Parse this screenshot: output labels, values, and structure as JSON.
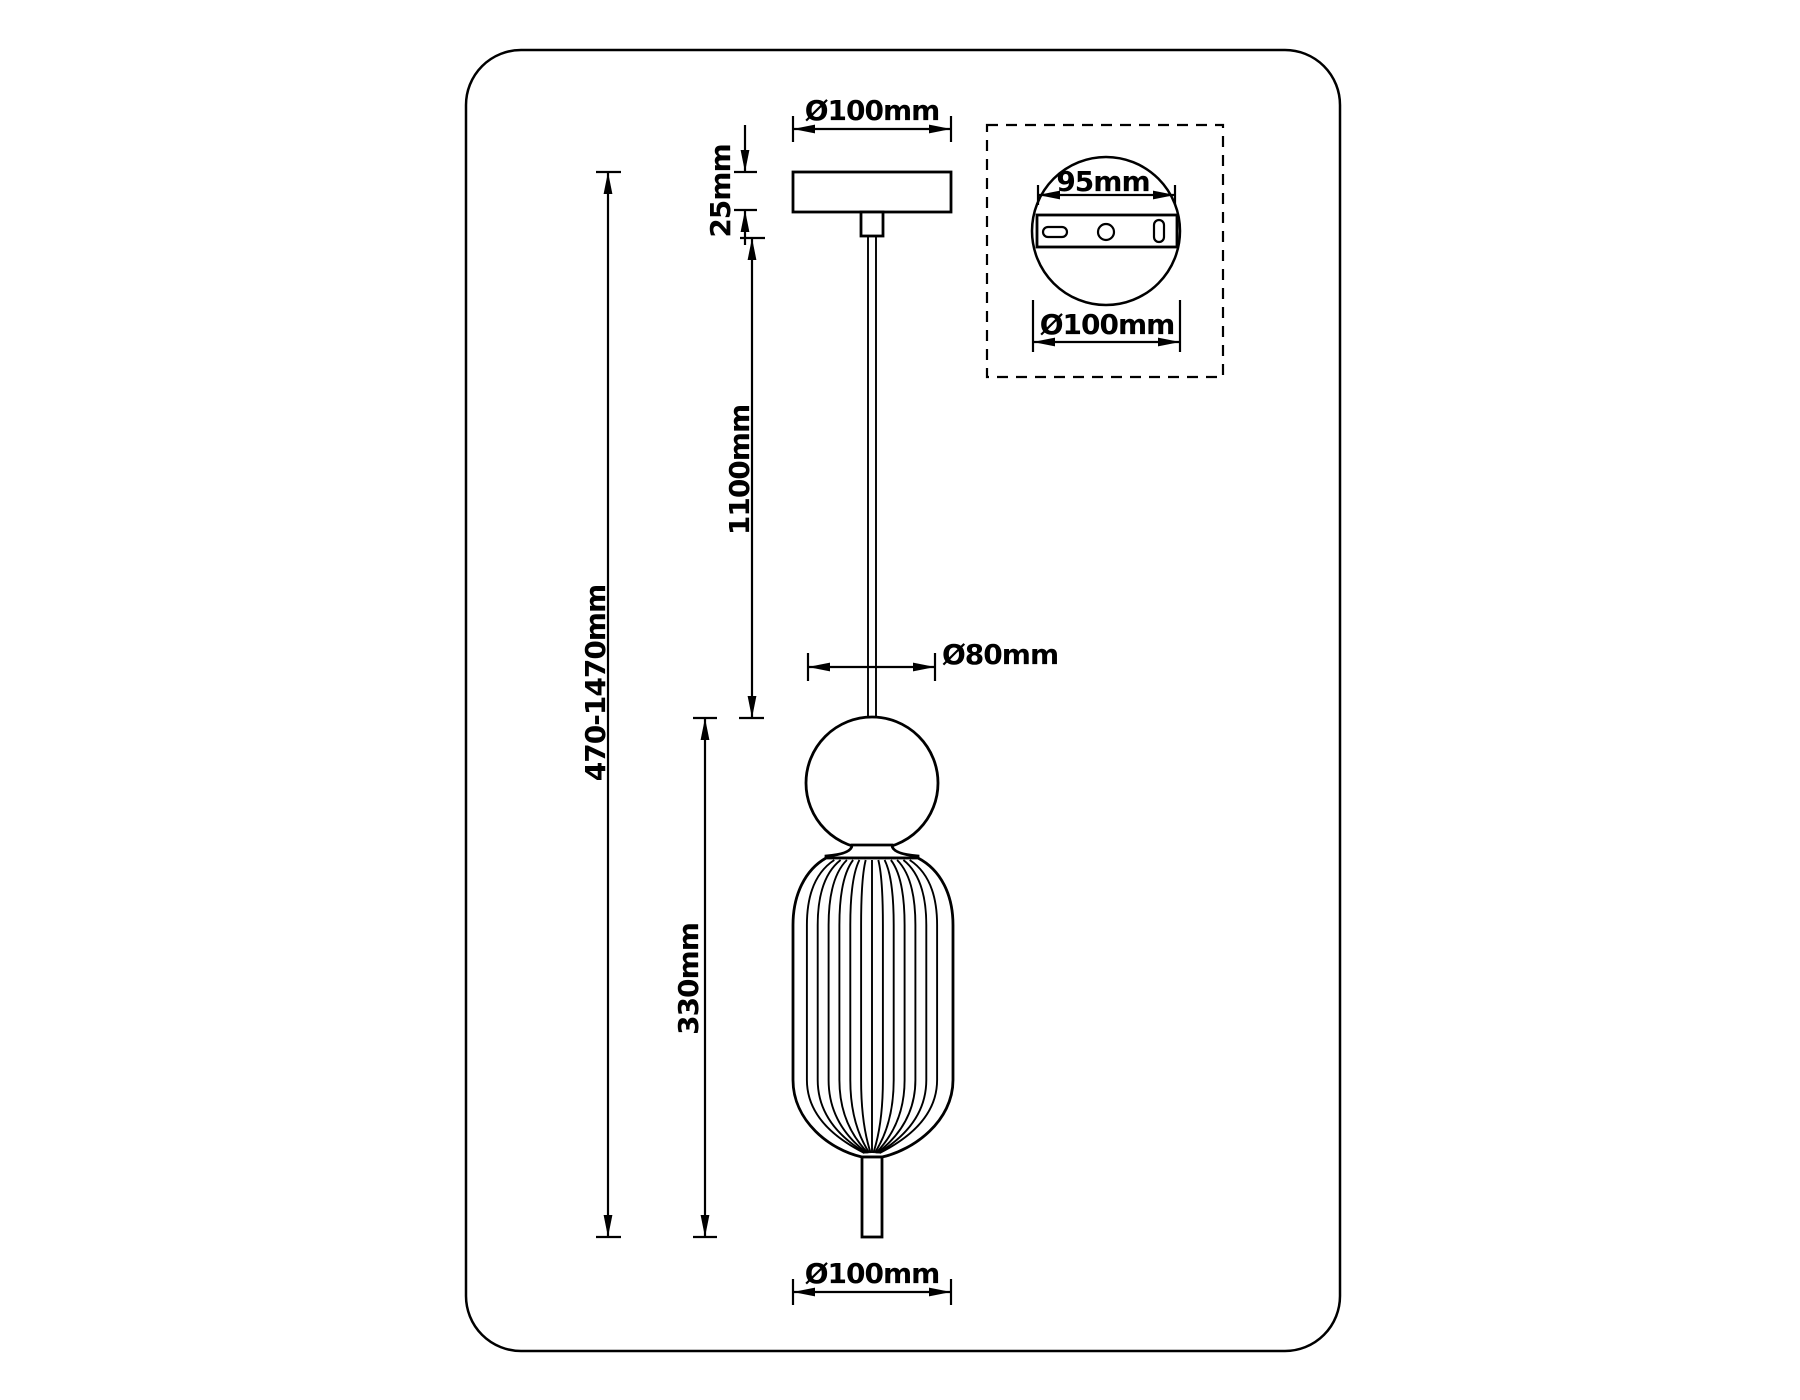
{
  "labels": {
    "canopy_diameter": "Ø100mm",
    "canopy_height": "25mm",
    "cable_length": "1100mm",
    "overall_height": "470-1470mm",
    "ball_diameter": "Ø80mm",
    "shade_height": "330mm",
    "shade_bottom_diameter": "Ø100mm",
    "inset_bracket_width": "95mm",
    "inset_plate_diameter": "Ø100mm"
  },
  "colors": {
    "line": "#000000",
    "background": "#ffffff"
  }
}
